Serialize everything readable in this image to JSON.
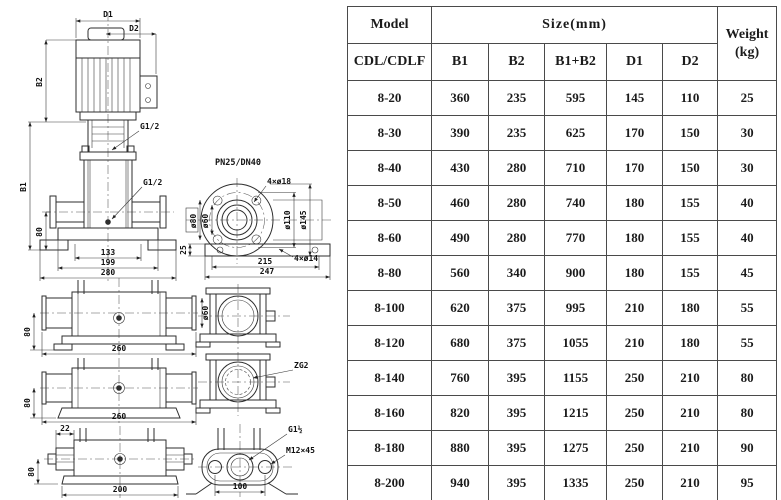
{
  "drawing": {
    "main": {
      "d1": "D1",
      "d2": "D2",
      "b2": "B2",
      "b1": "B1",
      "h80": "80",
      "g12_top": "G1/2",
      "g12_mid": "G1/2",
      "w133": "133",
      "w199": "199",
      "w280": "280"
    },
    "flange": {
      "pn": "PN25/DN40",
      "bolts_top": "4×ø18",
      "bolts_base": "4×ø14",
      "d80": "ø80",
      "d60": "ø60",
      "d110": "ø110",
      "d145": "ø145",
      "h25": "25",
      "w215": "215",
      "w247": "247"
    },
    "viewA": {
      "h80": "80",
      "d60": "ø60",
      "w260": "260"
    },
    "viewB": {
      "h80": "80",
      "w260": "260"
    },
    "viewC": {
      "off22": "22",
      "h80": "80",
      "w200": "200"
    },
    "viewE": {
      "zg2": "ZG2"
    },
    "viewF": {
      "g112": "G1½",
      "m12": "M12×45",
      "w100": "100"
    }
  },
  "table": {
    "header": {
      "model": "Model",
      "model_sub": "CDL/CDLF",
      "size": "Size(mm)",
      "weight_line1": "Weight",
      "weight_line2": "(kg)",
      "columns": [
        "B1",
        "B2",
        "B1+B2",
        "D1",
        "D2"
      ]
    },
    "rows": [
      {
        "model": "8-20",
        "b1": "360",
        "b2": "235",
        "b1b2": "595",
        "d1": "145",
        "d2": "110",
        "weight": "25"
      },
      {
        "model": "8-30",
        "b1": "390",
        "b2": "235",
        "b1b2": "625",
        "d1": "170",
        "d2": "150",
        "weight": "30"
      },
      {
        "model": "8-40",
        "b1": "430",
        "b2": "280",
        "b1b2": "710",
        "d1": "170",
        "d2": "150",
        "weight": "30"
      },
      {
        "model": "8-50",
        "b1": "460",
        "b2": "280",
        "b1b2": "740",
        "d1": "180",
        "d2": "155",
        "weight": "40"
      },
      {
        "model": "8-60",
        "b1": "490",
        "b2": "280",
        "b1b2": "770",
        "d1": "180",
        "d2": "155",
        "weight": "40"
      },
      {
        "model": "8-80",
        "b1": "560",
        "b2": "340",
        "b1b2": "900",
        "d1": "180",
        "d2": "155",
        "weight": "45"
      },
      {
        "model": "8-100",
        "b1": "620",
        "b2": "375",
        "b1b2": "995",
        "d1": "210",
        "d2": "180",
        "weight": "55"
      },
      {
        "model": "8-120",
        "b1": "680",
        "b2": "375",
        "b1b2": "1055",
        "d1": "210",
        "d2": "180",
        "weight": "55"
      },
      {
        "model": "8-140",
        "b1": "760",
        "b2": "395",
        "b1b2": "1155",
        "d1": "250",
        "d2": "210",
        "weight": "80"
      },
      {
        "model": "8-160",
        "b1": "820",
        "b2": "395",
        "b1b2": "1215",
        "d1": "250",
        "d2": "210",
        "weight": "80"
      },
      {
        "model": "8-180",
        "b1": "880",
        "b2": "395",
        "b1b2": "1275",
        "d1": "250",
        "d2": "210",
        "weight": "90"
      },
      {
        "model": "8-200",
        "b1": "940",
        "b2": "395",
        "b1b2": "1335",
        "d1": "250",
        "d2": "210",
        "weight": "95"
      }
    ]
  }
}
